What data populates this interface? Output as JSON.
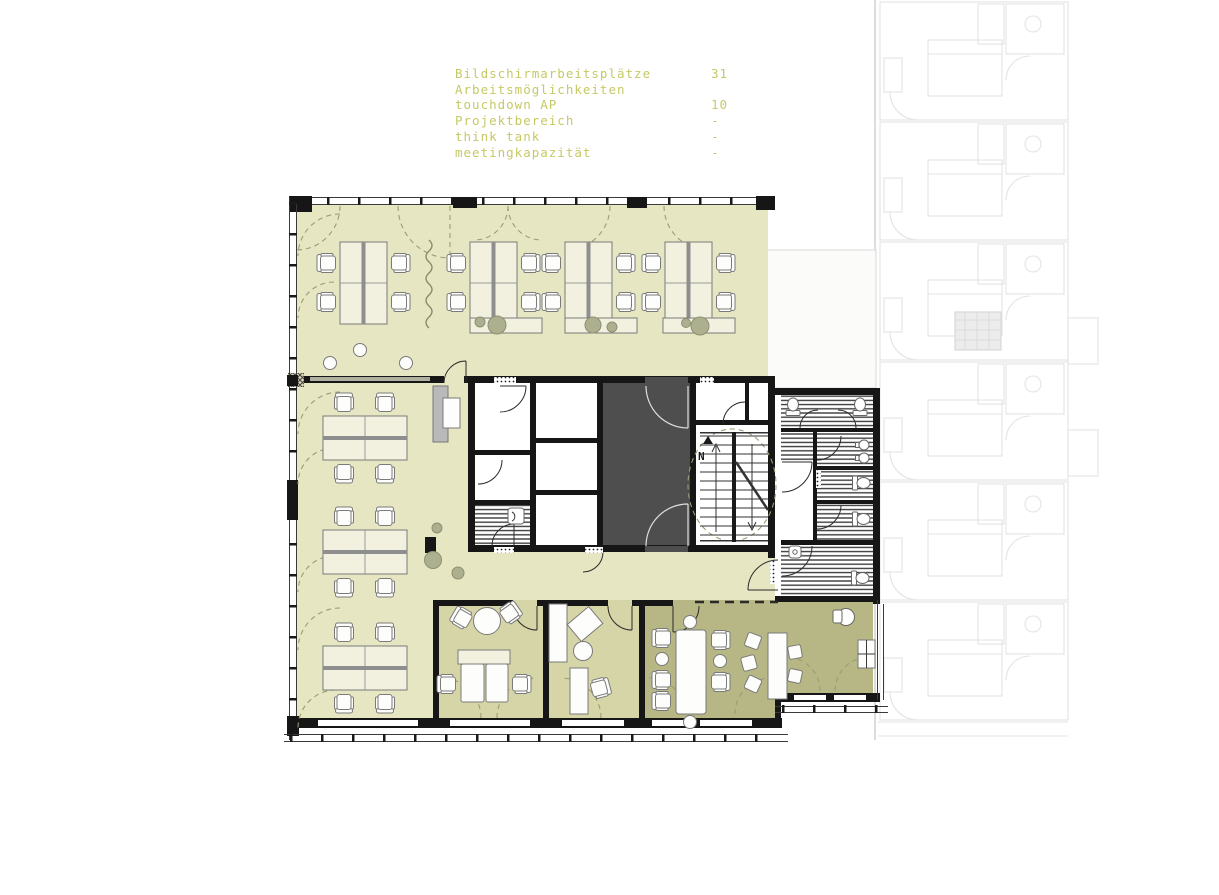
{
  "legend": {
    "rows": [
      {
        "label": "Bildschirmarbeitsplätze",
        "value": "31"
      },
      {
        "label": "Arbeitsmöglichkeiten",
        "value": ""
      },
      {
        "label": "touchdown AP",
        "value": "10"
      },
      {
        "label": "Projektbereich",
        "value": "-"
      },
      {
        "label": "think tank",
        "value": "-"
      },
      {
        "label": "meetingkapazität",
        "value": "-"
      }
    ]
  },
  "annotations": {
    "north_label": "N"
  },
  "colors": {
    "open_office_floor": "#e7e6c2",
    "room_floor": "#d6d5a7",
    "meeting_floor": "#b7b685",
    "core_dark": "#4e4e4e",
    "wall": "#161616",
    "legend_text": "#c6c964",
    "background_plan_line": "#e3e3e3",
    "dashed_swing": "#9b9b77"
  }
}
